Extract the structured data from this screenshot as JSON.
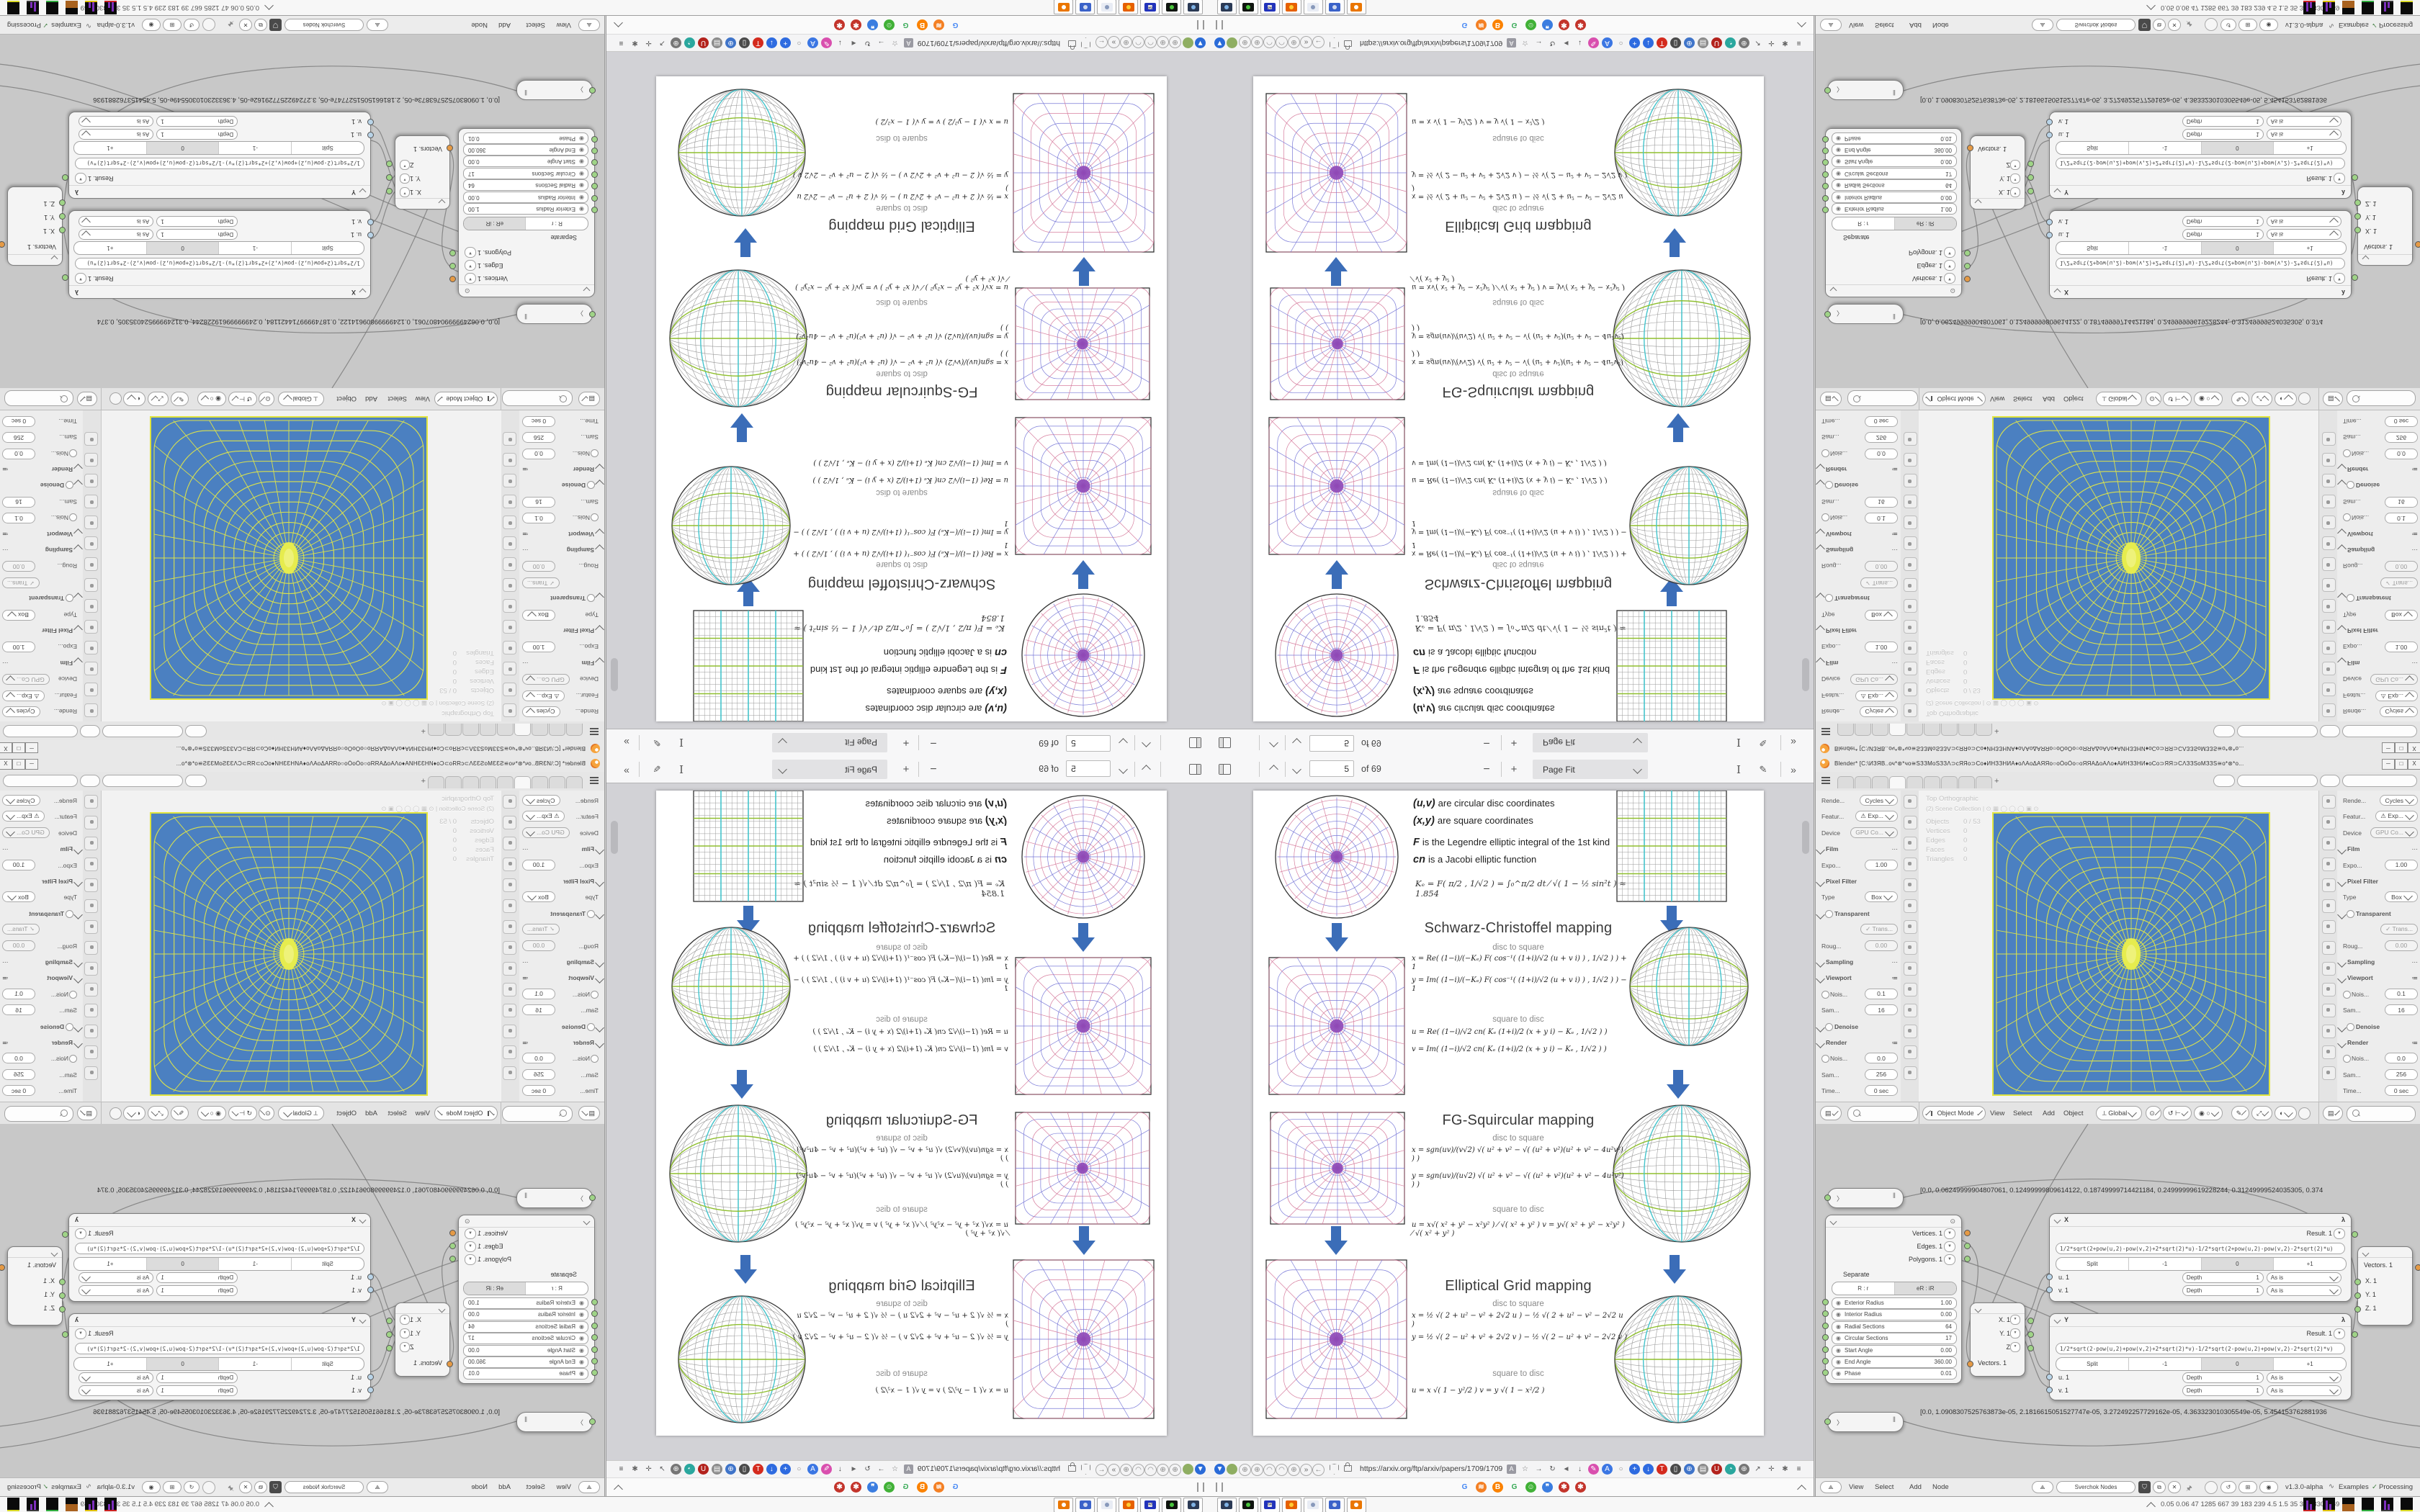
{
  "pdf_viewer": {
    "toolbar": {
      "page_input": "5",
      "page_count_label": "of 69",
      "zoom_out_label": "−",
      "zoom_in_label": "+",
      "zoom_select_label": "Page Fit",
      "text_tool_label": "I",
      "draw_tool_label": "✎",
      "more_tools_label": "»"
    },
    "page": {
      "intro_lines": [
        {
          "lead": "(u,v)",
          "rest": "are circular disc coordinates"
        },
        {
          "lead": "(x,y)",
          "rest": "are square coordinates"
        },
        {
          "lead": "F",
          "rest": "is the Legendre elliptic integral of the 1st kind"
        },
        {
          "lead": "cn",
          "rest": "is a Jacobi elliptic function"
        }
      ],
      "ke_formula": "Kₑ =  F( π/2 , 1/√2 ) = ∫₀^π/2  dt ⁄ √( 1 − ½ sin²t )   ≈ 1.854",
      "sections": [
        {
          "title": "Schwarz-Christoffel mapping",
          "disc_to_square_label": "disc to square",
          "square_to_disc_label": "square to disc",
          "disc_to_square_formulas": [
            "x = Re( (1−i)/(−Kₑ) F( cos⁻¹( (1+i)/√2 (u + v i) ) , 1/√2 ) ) + 1",
            "y = Im( (1−i)/(−Kₑ) F( cos⁻¹( (1+i)/√2 (u + v i) ) , 1/√2 ) ) − 1"
          ],
          "square_to_disc_formulas": [
            "u = Re( (1−i)/√2  cn( Kₑ (1+i)/2 (x + y i) − Kₑ , 1/√2 ) )",
            "v = Im( (1−i)/√2  cn( Kₑ (1+i)/2 (x + y i) − Kₑ , 1/√2 ) )"
          ]
        },
        {
          "title": "FG-Squircular mapping",
          "disc_to_square_label": "disc to square",
          "square_to_disc_label": "square to disc",
          "disc_to_square_formulas": [
            "x = sgn(uv)/(v√2) √( u² + v² − √( (u² + v²)(u² + v² − 4u²v²) ) )",
            "y = sgn(uv)/(u√2) √( u² + v² − √( (u² + v²)(u² + v² − 4u²v²) ) )"
          ],
          "square_to_disc_formulas": [
            "u = x√( x² + y² − x²y² ) ⁄ √( x² + y² )        v = y√( x² + y² − x²y² ) ⁄ √( x² + y² )"
          ]
        },
        {
          "title": "Elliptical Grid mapping",
          "disc_to_square_label": "disc to square",
          "square_to_disc_label": "square to disc",
          "disc_to_square_formulas": [
            "x = ½ √( 2 + u² − v² + 2√2 u )  −  ½ √( 2 + u² − v² − 2√2 u )",
            "y = ½ √( 2 − u² + v² + 2√2 v )  −  ½ √( 2 − u² + v² − 2√2 v )"
          ],
          "square_to_disc_formulas": [
            "u = x √( 1 − y²/2 )            v = y √( 1 − x²/2 )"
          ]
        }
      ]
    },
    "nav_bar": {
      "url": "https://arxiv.org/ftp/arxiv/papers/1709/1709",
      "translate_badge": "A",
      "left_icons": [
        {
          "g": "▼",
          "bg": "#2a6bd8",
          "c": "#fff"
        },
        {
          "g": "",
          "bg": "#8fae62",
          "c": "#dff0d0"
        },
        {
          "g": "⊕",
          "c": "#8a8a8a"
        },
        {
          "g": "⊕",
          "c": "#8a8a8a"
        },
        {
          "g": "◠",
          "c": "#8a8a8a"
        },
        {
          "g": "◠",
          "c": "#8a8a8a"
        },
        {
          "g": "⊕",
          "c": "#8a8a8a"
        },
        {
          "g": "»",
          "c": "#666"
        },
        {
          "g": "←",
          "c": "#777"
        }
      ],
      "right_icons": [
        {
          "g": "☆",
          "c": "#777"
        },
        {
          "g": "→",
          "c": "#555"
        },
        {
          "g": "↻",
          "c": "#555"
        },
        {
          "g": "◄",
          "c": "#666"
        },
        {
          "g": "↓",
          "c": "#444"
        },
        {
          "g": "✎",
          "bg": "#d94fae",
          "c": "#fff"
        },
        {
          "g": "A",
          "bg": "#3b76e3",
          "c": "#fff"
        },
        {
          "g": "○",
          "c": "#888"
        },
        {
          "g": "+",
          "bg": "#2e6be0",
          "c": "#fff"
        },
        {
          "g": "↓",
          "bg": "#2e6be0",
          "c": "#fff"
        },
        {
          "g": "T",
          "bg": "#d42a1d",
          "c": "#fff"
        },
        {
          "g": "▯",
          "bg": "#4a4a4a",
          "c": "#fff"
        },
        {
          "g": "⊕",
          "bg": "#3f74c9",
          "c": "#fff"
        },
        {
          "g": "▤",
          "bg": "#8a8a8a",
          "c": "#fff"
        },
        {
          "g": "U",
          "bg": "#b3221c",
          "c": "#fff"
        },
        {
          "g": "◔",
          "bg": "#2aa79e",
          "c": "#fff"
        },
        {
          "g": "⊕",
          "bg": "#767676",
          "c": "#fff"
        },
        {
          "g": "↗",
          "c": "#555"
        },
        {
          "g": "✛",
          "c": "#666"
        },
        {
          "g": "✱",
          "c": "#666"
        },
        {
          "g": "≡",
          "c": "#444"
        }
      ]
    },
    "bookmarks_bar": {
      "collapse_label": "^",
      "icons": [
        {
          "g": "G",
          "c": "#4285F4"
        },
        {
          "g": "≋",
          "bg": "#f48024",
          "c": "#fff"
        },
        {
          "g": "B",
          "bg": "#fb8200",
          "c": "#fff"
        },
        {
          "g": "G",
          "c": "#34a853"
        },
        {
          "g": "☺",
          "bg": "#41b137",
          "c": "#fff"
        },
        {
          "g": "❞",
          "bg": "#3b7de0",
          "c": "#fff"
        },
        {
          "g": "✱",
          "bg": "#c3342b",
          "c": "#fff"
        },
        {
          "g": "✱",
          "bg": "#c3342b",
          "c": "#fff"
        }
      ]
    }
  },
  "blender": {
    "title": "Blender* [C:\\ИЗЯВ..оч*⊛*чо≅ЅЗЗМоЅЗЗΛ⊃сЯЯо⊃Со♦ИНЗЗНИА♦оΛАоΔАЯЯо○оÓоÒо○оЯЯАΔоАΛо♦АИНЗЗНИ♦оСо⊃ЯЯ⊃СΛЗЗЅоМЗЗЅ≅о*⊛*о...",
    "window_buttons": [
      "─",
      "□",
      "X"
    ],
    "topbar": {
      "tab_count": 9,
      "active_tab": 3,
      "new_tab_label": "+"
    },
    "properties": {
      "rows": [
        {
          "label": "Rende...",
          "value": "Cycles",
          "dd": true
        },
        {
          "label": "Featur...",
          "value": "⚠ Exp...",
          "dd": true
        },
        {
          "label": "Device",
          "value": "GPU Co...",
          "dd": true,
          "dim": true
        },
        {
          "sec": "Film",
          "dots": "⋯"
        },
        {
          "label": "Expo...",
          "value": "1.00"
        },
        {
          "sec": "Pixel Filter"
        },
        {
          "label": "Type",
          "value": "Box",
          "dd": true
        },
        {
          "sec": "Transparent",
          "chk": true
        },
        {
          "label": "",
          "value": "✓ Trans...",
          "dim": true
        },
        {
          "label": "Roug...",
          "value": "0.00",
          "dim": true
        },
        {
          "sec": "Sampling",
          "dots": "⋯"
        },
        {
          "sec": "Viewport",
          "dots": "≔"
        },
        {
          "label": "Nois...",
          "value": "0.1",
          "chk": true
        },
        {
          "label": "Sam...",
          "value": "16"
        },
        {
          "sec": "Denoise",
          "chk": true,
          "closed": true
        },
        {
          "sec": "Render",
          "dots": "≔"
        },
        {
          "label": "Nois...",
          "value": "0.0",
          "chk": true
        },
        {
          "label": "Sam...",
          "value": "256"
        },
        {
          "label": "Time...",
          "value": "0 sec"
        }
      ],
      "tab_count": 14
    },
    "viewport": {
      "view_label": "Top Orthographic",
      "collection_label": "(2) Scene Collection |  ⊙ ▦ ◯ ◯ ◯ ▣ ⊙",
      "stats": [
        [
          "Objects",
          "0 / 53"
        ],
        [
          "Vertices",
          "0"
        ],
        [
          "Edges",
          "0"
        ],
        [
          "Faces",
          "0"
        ],
        [
          "Triangles",
          "0"
        ]
      ]
    },
    "headers": {
      "mode_label": "Object Mode",
      "menus_3d": [
        "View",
        "Select",
        "Add",
        "Object"
      ],
      "orientation_label": "Global"
    },
    "nodes": {
      "stethoscope_1": "[0.0, 0.06249999904807061, 0.12499999809614122, 0.18749999714421184, 0.24999999619228244, 0.31249999524035305, 0.374",
      "stethoscope_2": "[0.0, 1.0908307525763873e-05, 2.1816615051527747e-05, 3.272492257729162e-05, 4.363323010305549e-05, 5.454153762881936",
      "torus": {
        "outputs": [
          {
            "name": "Vertices. 1",
            "color": "o"
          },
          {
            "name": "Edges. 1",
            "color": "g"
          },
          {
            "name": "Polygons. 1",
            "color": "g"
          }
        ],
        "separate_label": "Separate",
        "mode_toggle": [
          "R : r",
          "eR : iR"
        ],
        "mode_active": 1,
        "fields": [
          [
            "Exterior Radius",
            "1.00"
          ],
          [
            "Interior Radius",
            "0.00"
          ],
          [
            "Radial Sections",
            "64"
          ],
          [
            "Circular Sections",
            "17"
          ],
          [
            "Start Angle",
            "0.00"
          ],
          [
            "End Angle",
            "360.00"
          ],
          [
            "Phase",
            "0.01"
          ]
        ]
      },
      "x_node": {
        "name": "X",
        "result_label": "Result. 1",
        "formula": "1/2*sqrt(2+pow(u,2)-pow(v,2)+2*sqrt(2)*u)-1/2*sqrt(2+pow(u,2)-pow(v,2)-2*sqrt(2)*u)",
        "split_options": [
          "Split",
          "-1",
          "0",
          "+1"
        ],
        "split_active": 2,
        "sockets": [
          "u. 1",
          "v. 1"
        ],
        "depth_label": "Depth",
        "depth_value": "1",
        "wrap_label": "As is"
      },
      "y_node": {
        "name": "Y",
        "result_label": "Result. 1",
        "formula": "1/2*sqrt(2-pow(u,2)+pow(v,2)+2*sqrt(2)*v)-1/2*sqrt(2-pow(u,2)+pow(v,2)-2*sqrt(2)*v)",
        "split_options": [
          "Split",
          "-1",
          "0",
          "+1"
        ],
        "split_active": 2,
        "sockets": [
          "u. 1",
          "v. 1"
        ],
        "depth_label": "Depth",
        "depth_value": "1",
        "wrap_label": "As is"
      },
      "vector_out": {
        "outputs": [
          "X. 1",
          "Y. 1",
          "Z"
        ],
        "input": "Vectors. 1"
      },
      "vector_in": {
        "output": "Vectors. 1",
        "inputs": [
          "X. 1",
          "Y. 1",
          "Z. 1"
        ]
      }
    },
    "node_header": {
      "menus": [
        "View",
        "Select",
        "Add",
        "Node"
      ],
      "tree_name": "Sverchok Nodes",
      "version": "v1.3.0-alpha",
      "examples_label": "Examples",
      "processing_label": "Processing"
    }
  },
  "taskbar": {
    "stats_text": "0.05 0.06   47   1285 667   39   183   239   4.5   1.5   35   31   58307169",
    "quick_launch": [
      {
        "name": "screenshot-tool",
        "c1": "#2b3a55",
        "c2": "#7fb2e5"
      },
      {
        "name": "card-reader-app",
        "c1": "#101510",
        "c2": "#49c53c"
      },
      {
        "name": "floppy-64-app",
        "c1": "#2233bb",
        "c2": "#e8e8e8",
        "t": "64"
      },
      {
        "name": "firefox",
        "c1": "#e66000",
        "c2": "#ffcc33"
      },
      {
        "name": "notepad",
        "c1": "#e8ecf4",
        "c2": "#8899bb"
      },
      {
        "name": "window-app",
        "c1": "#3a62c9",
        "c2": "#cfd8ee"
      },
      {
        "name": "blender-app",
        "c1": "#ea7600",
        "c2": "#ffffff"
      }
    ],
    "graph_tiles": [
      {
        "spike": "#7d2fbd",
        "strip": "#cc2222"
      },
      {
        "spike": "#7d2fbd",
        "strip": "#e0c000"
      },
      {
        "fill": "#a9621f",
        "strip": "#a9621f"
      },
      {
        "strip": "#2fae3e"
      },
      {
        "spike": "#7d2fbd",
        "strip": "#3a3a3a"
      },
      {
        "strip": "#d9d925"
      }
    ]
  }
}
